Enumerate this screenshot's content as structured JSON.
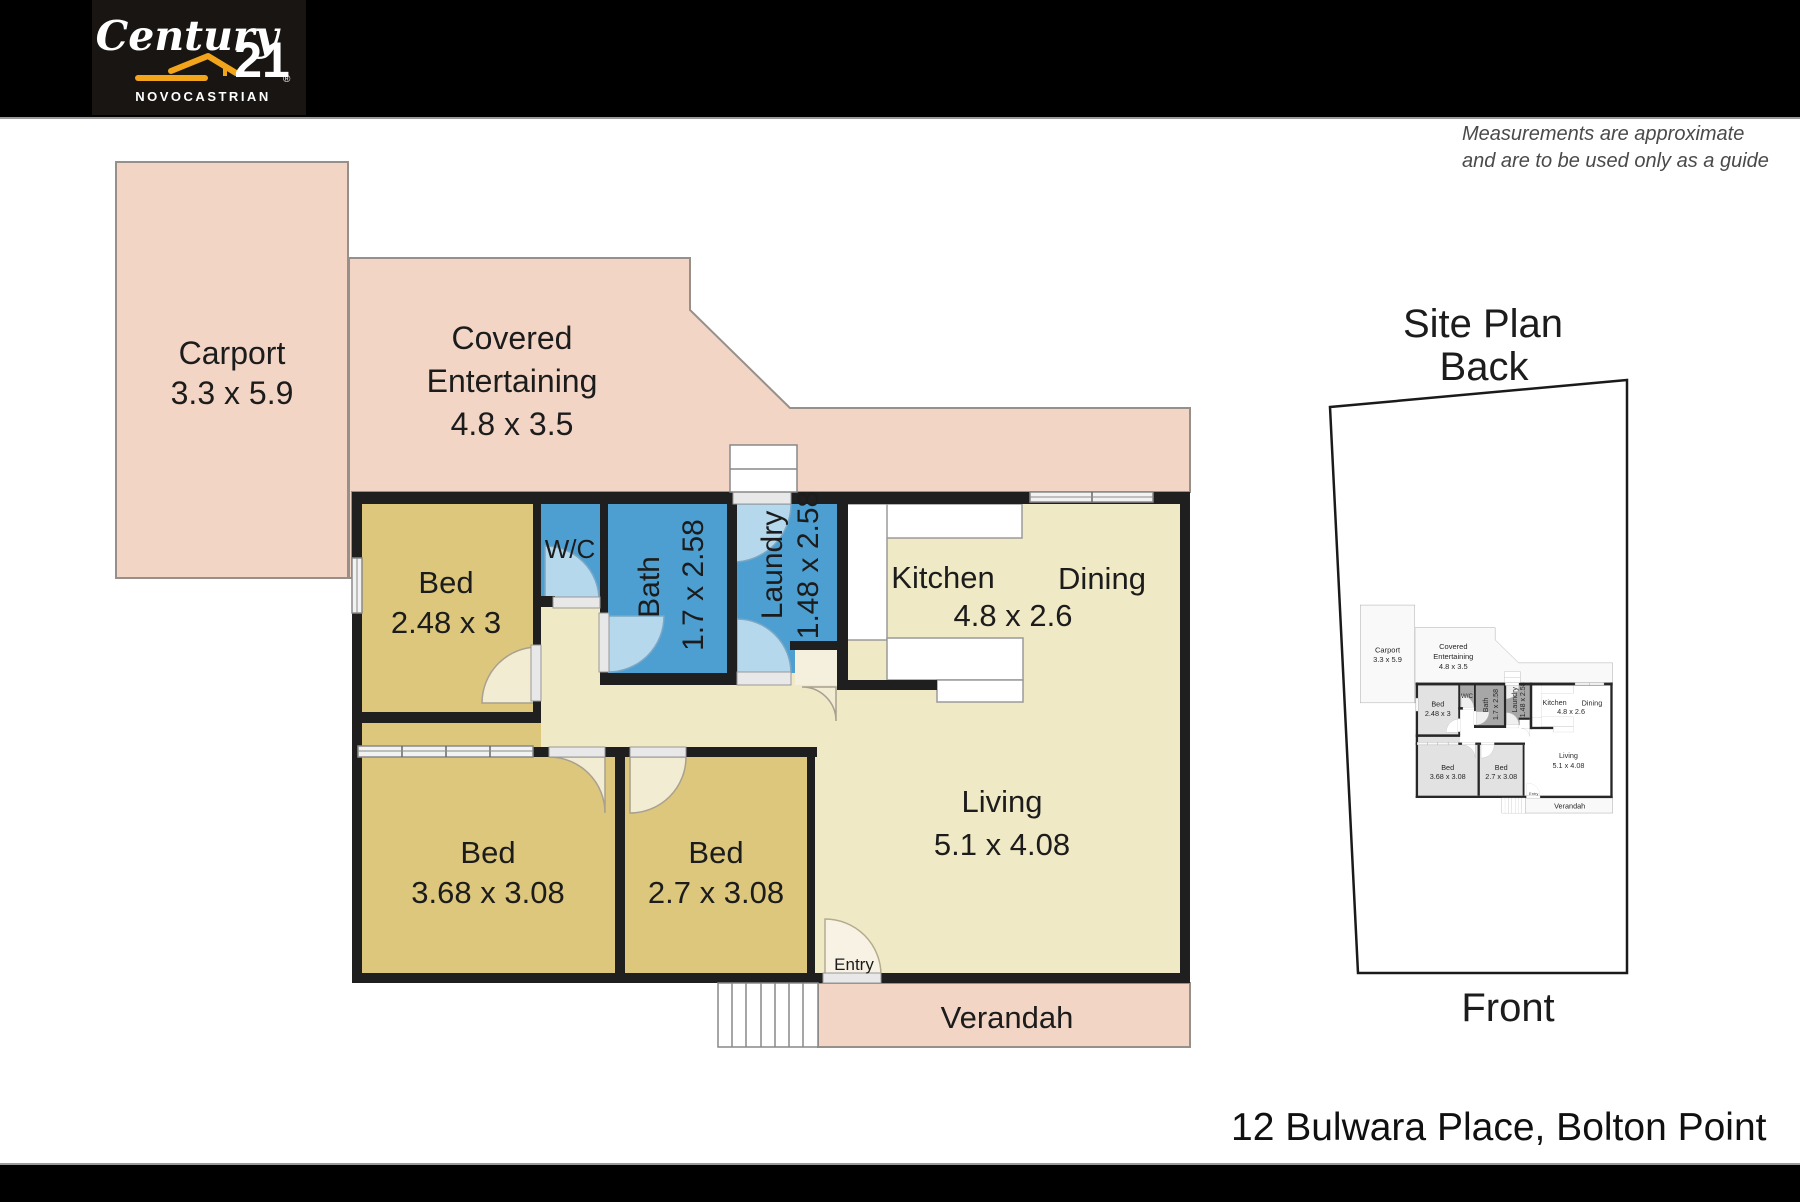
{
  "header": {
    "logo": {
      "script": "Century",
      "number": "21",
      "registered": "®",
      "subtitle": "NOVOCASTRIAN"
    }
  },
  "disclaimer": {
    "line1": "Measurements are approximate",
    "line2": "and are to be used only as a guide"
  },
  "floor_plan": {
    "carport": {
      "name": "Carport",
      "dims": "3.3 x 5.9"
    },
    "covered_entertaining": {
      "line1": "Covered",
      "line2": "Entertaining",
      "dims": "4.8 x 3.5"
    },
    "bed1": {
      "name": "Bed",
      "dims": "2.48 x 3"
    },
    "wc": {
      "name": "W/C"
    },
    "bath": {
      "name": "Bath",
      "dims": "1.7 x 2.58"
    },
    "laundry": {
      "name": "Laundry",
      "dims": "1.48 x 2.58"
    },
    "kitchen": {
      "name": "Kitchen"
    },
    "dining": {
      "name": "Dining"
    },
    "kitchen_dining_dims": "4.8 x 2.6",
    "living": {
      "name": "Living",
      "dims": "5.1 x 4.08"
    },
    "bed2": {
      "name": "Bed",
      "dims": "3.68 x 3.08"
    },
    "bed3": {
      "name": "Bed",
      "dims": "2.7 x 3.08"
    },
    "entry": "Entry",
    "verandah": "Verandah"
  },
  "site_plan": {
    "title": "Site Plan",
    "back_label": "Back",
    "front_label": "Front"
  },
  "address": "12 Bulwara Place, Bolton Point",
  "colors": {
    "outdoor_pink": "#f2d5c5",
    "bedroom_tan": "#dcc77d",
    "wet_area_blue": "#4d9fd2",
    "floor_cream": "#f0e9c5",
    "door_arc_blue": "#b5d8ec",
    "wall_black": "#1f1f1f",
    "logo_gold": "#F2A51B"
  }
}
